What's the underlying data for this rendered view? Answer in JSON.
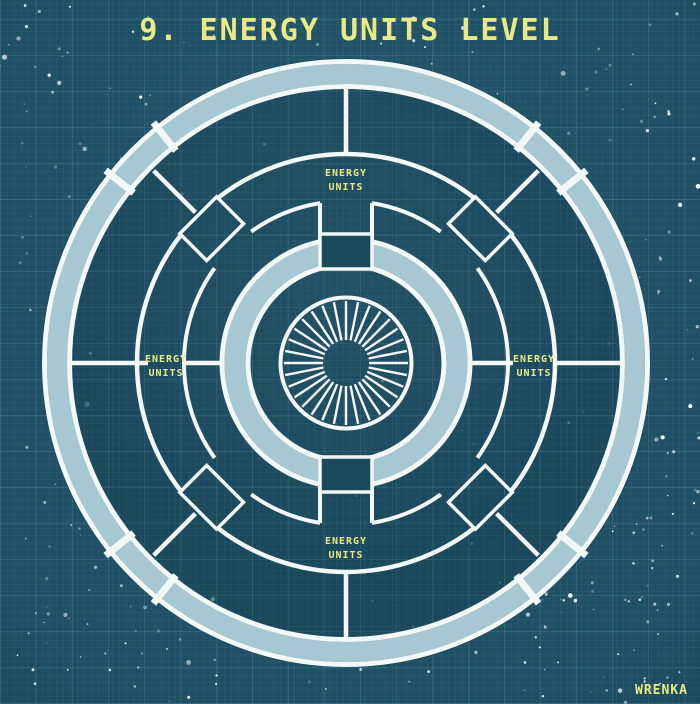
{
  "title": "9. ENERGY UNITS LEVEL",
  "signature": "WRENKA",
  "labels": {
    "top": {
      "line1": "ENERGY",
      "line2": "UNITS"
    },
    "right": {
      "line1": "ENERGY",
      "line2": "UNITS"
    },
    "bottom": {
      "line1": "ENERGY",
      "line2": "UNITS"
    },
    "left": {
      "line1": "ENERGY",
      "line2": "UNITS"
    }
  },
  "diagram": {
    "description": "circular station deck plan",
    "level_number": "9",
    "energy_unit_sections": 4,
    "turbine_blades": 32
  },
  "colors": {
    "background": "#1f5065",
    "grid": "#8ccde6",
    "band_fill": "#a7c8d3",
    "line_white": "#f2f7f8",
    "accent_yellow": "#e9e985",
    "interior_shade": "#1c4a5d"
  }
}
